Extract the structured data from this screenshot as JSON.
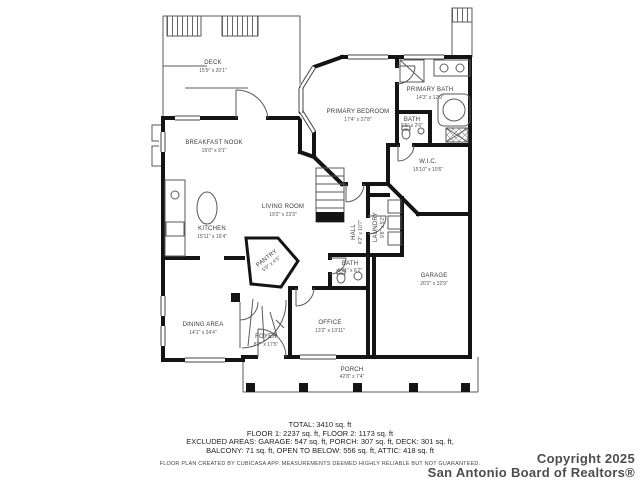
{
  "plan": {
    "rooms": [
      {
        "id": "deck",
        "name": "DECK",
        "dims": "15'9\" x 20'1\""
      },
      {
        "id": "breakfast-nook",
        "name": "BREAKFAST NOOK",
        "dims": "15'0\" x 9'1\""
      },
      {
        "id": "kitchen",
        "name": "KITCHEN",
        "dims": "15'11\" x 16'4\""
      },
      {
        "id": "living-room",
        "name": "LIVING ROOM",
        "dims": "19'2\" x 23'3\""
      },
      {
        "id": "pantry",
        "name": "PANTRY",
        "dims": "5'0\" x 4'5\""
      },
      {
        "id": "dining-area",
        "name": "DINING AREA",
        "dims": "14'1\" x 24'4\""
      },
      {
        "id": "foyer",
        "name": "FOYER",
        "dims": "8'7\" x 17'5\""
      },
      {
        "id": "office",
        "name": "OFFICE",
        "dims": "13'2\" x 13'11\""
      },
      {
        "id": "bath-first-floor",
        "name": "BATH",
        "dims": "5'11\" x 6'2\""
      },
      {
        "id": "hall",
        "name": "HALL",
        "dims": "4'2\" x 10'7\""
      },
      {
        "id": "laundry",
        "name": "LAUNDRY",
        "dims": "9'8\" x 5'2\""
      },
      {
        "id": "primary-bedroom",
        "name": "PRIMARY BEDROOM",
        "dims": "17'4\" x 27'8\""
      },
      {
        "id": "primary-bath",
        "name": "PRIMARY BATH",
        "dims": "14'3\" x 12'9\""
      },
      {
        "id": "bath-primary-wc",
        "name": "BATH",
        "dims": "5'9\" x 2'6\""
      },
      {
        "id": "wic",
        "name": "W.I.C.",
        "dims": "15'10\" x 10'6\""
      },
      {
        "id": "garage",
        "name": "GARAGE",
        "dims": "20'2\" x 32'9\""
      },
      {
        "id": "porch",
        "name": "PORCH",
        "dims": "42'8\" x 7'4\""
      }
    ]
  },
  "footer": {
    "line1": "TOTAL: 3410 sq. ft",
    "line2": "FLOOR 1: 2237 sq. ft, FLOOR 2: 1173 sq. ft",
    "line3": "EXCLUDED AREAS: GARAGE: 547 sq. ft, PORCH: 307 sq. ft, DECK: 301 sq. ft,",
    "line4": "BALCONY: 71 sq. ft, OPEN TO BELOW: 556 sq. ft, ATTIC: 418 sq. ft",
    "disclaimer": "FLOOR PLAN CREATED BY CUBICASA APP. MEASUREMENTS DEEMED HIGHLY RELIABLE BUT NOT GUARANTEED."
  },
  "copyright": {
    "line1": "Copyright 2025",
    "line2": "San Antonio Board of Realtors®"
  },
  "colors": {
    "wall": "#141414",
    "thin_line": "#5a5a5a",
    "label_text": "#3a3a3a",
    "background": "#ffffff"
  }
}
